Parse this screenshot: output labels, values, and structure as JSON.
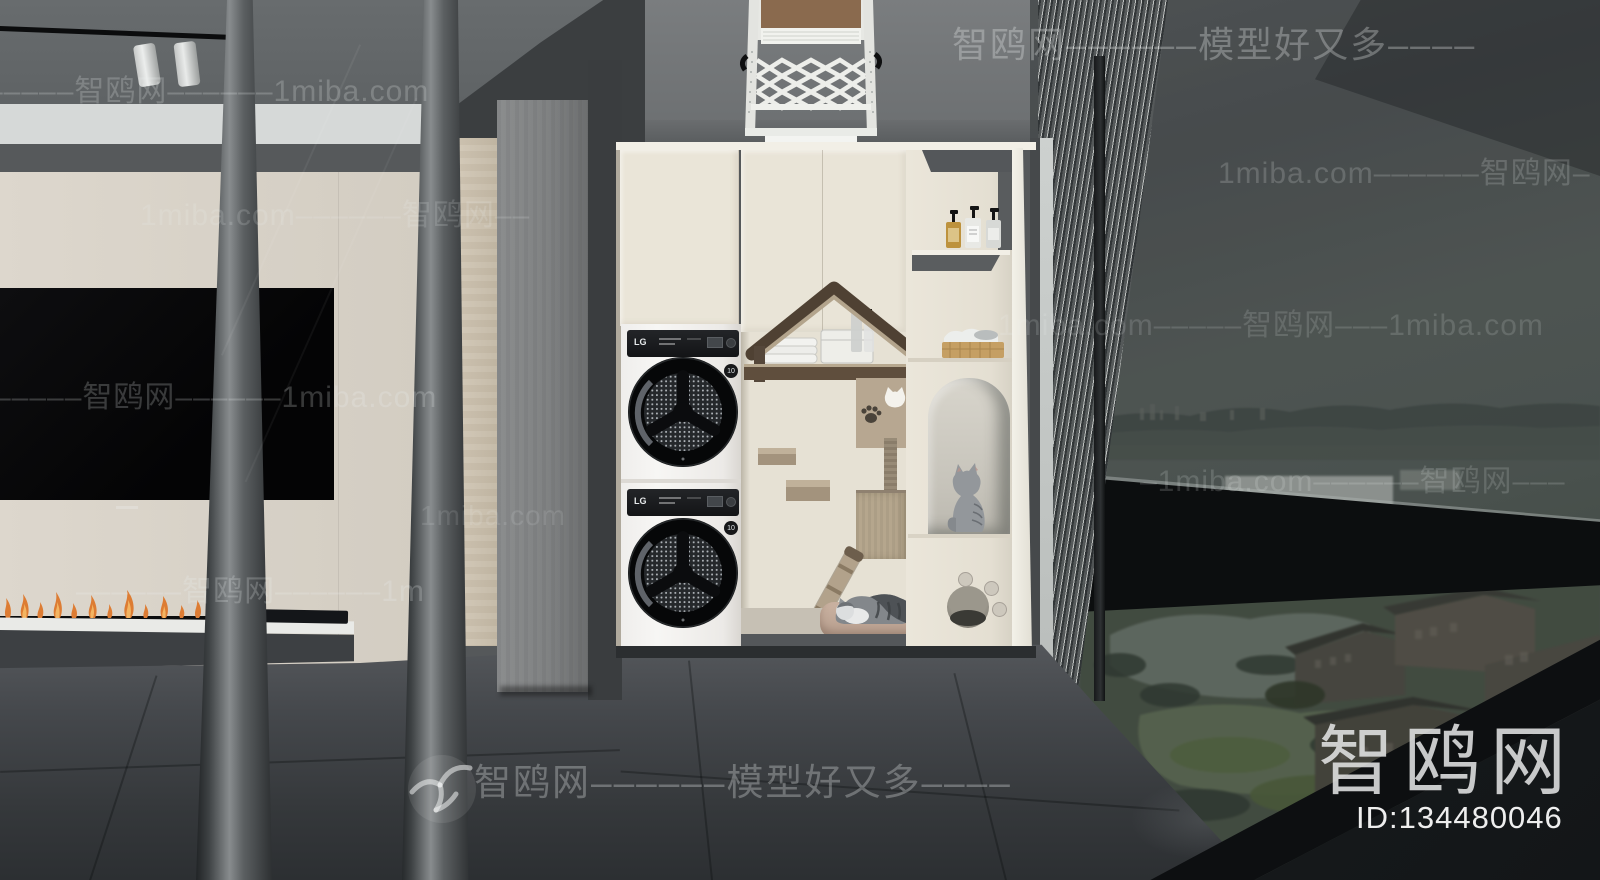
{
  "watermarks": {
    "top_right": "智鸥网––––––模型好又多––––",
    "row_upper_left": "–––––智鸥网––––––1miba.com",
    "row_right_1": "1miba.com––––––智鸥网–",
    "row_left_1": "1miba.com––––––智鸥网––",
    "row_right_2": "1miba.com–––––智鸥网–––1miba.com",
    "row_tv": "–––––智鸥网––––––1miba.com",
    "row_door_site": "1miba.com",
    "row_right_3": "–1miba.com––––––智鸥网–––",
    "row_floor_left": "––––––智鸥网––––––1m",
    "bottom_center": "智鸥网––––––模型好又多––––"
  },
  "branding": {
    "site_logo": "智鸥网",
    "model_id": "ID:134480046"
  },
  "appliances": {
    "brand": "LG",
    "warranty_badge": "10"
  },
  "colors": {
    "cream_cabinet": "#e9e4d8",
    "cream_wall": "#d9d3c9",
    "dark_floor": "#3e4143",
    "roof_brown": "#564739",
    "tan_wood": "#b5a58e",
    "flame_orange": "#dd7c33",
    "watermark_white": "#ffffff"
  }
}
